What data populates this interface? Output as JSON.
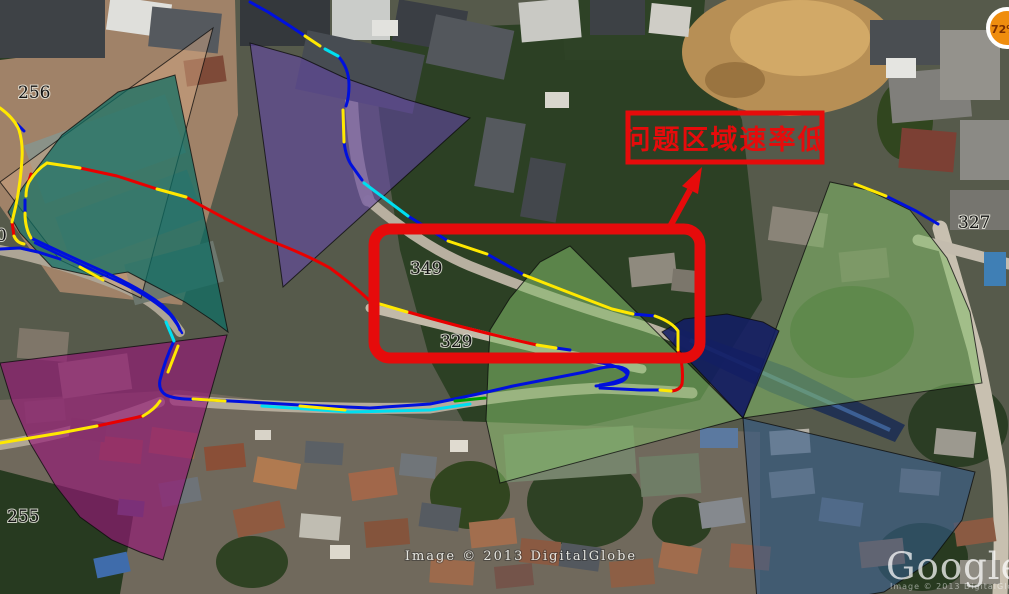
{
  "map": {
    "annotation": {
      "text": "问题区域速率低"
    },
    "cell_labels": [
      {
        "value": "256"
      },
      {
        "value": "0"
      },
      {
        "value": "255"
      },
      {
        "value": "349"
      },
      {
        "value": "329"
      },
      {
        "value": "327"
      }
    ],
    "badge": {
      "text": "72%"
    },
    "watermark": {
      "credit_center": "Image © 2013 DigitalGlobe",
      "logo_text": "Google e",
      "logo_credit": "Image © 2013 DigitalGlobe"
    },
    "overlays": {
      "sectors": [
        "tan",
        "teal",
        "purple",
        "magenta",
        "green-center",
        "green-east",
        "blue-south",
        "navy"
      ],
      "routes": [
        "blue",
        "yellow",
        "cyan",
        "red",
        "green"
      ]
    },
    "colors": {
      "annotation_red": "#e60b0b",
      "route_yellow": "#ffe800",
      "route_blue": "#0010dd",
      "route_cyan": "#00dff0",
      "route_red": "#e80000",
      "route_green": "#00a000",
      "sector_tan": "rgba(210,165,130,0.5)",
      "sector_teal": "rgba(13,110,100,0.72)",
      "sector_purple": "rgba(100,72,165,0.6)",
      "sector_magenta": "rgba(148,24,118,0.66)",
      "sector_green": "rgba(132,188,106,0.55)",
      "sector_blue": "rgba(52,92,138,0.6)",
      "sector_navy": "rgba(18,28,100,0.88)"
    }
  }
}
